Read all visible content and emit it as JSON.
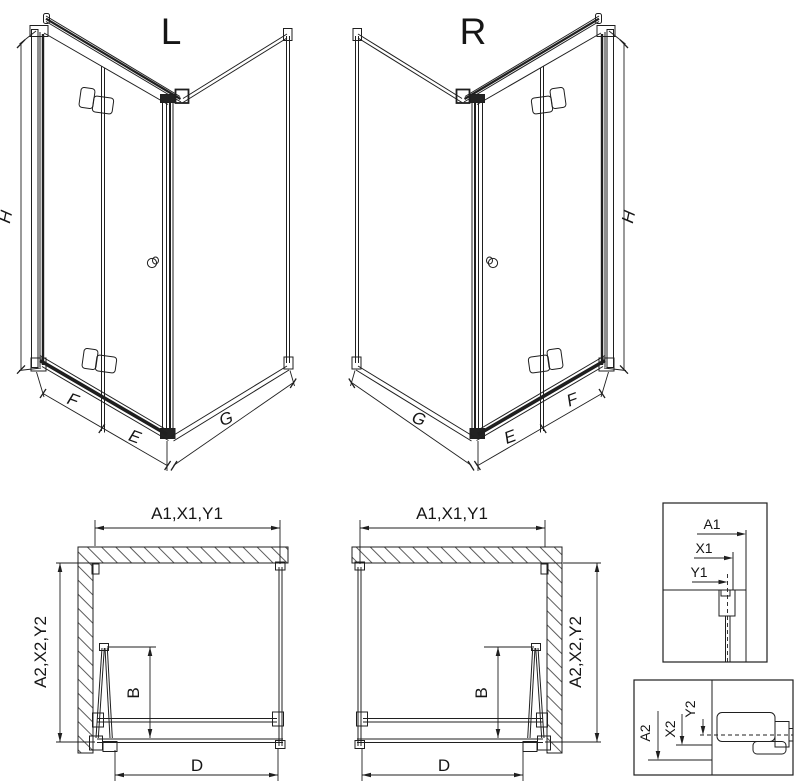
{
  "background": "#ffffff",
  "line_color": "#1f1f1f",
  "iso_left": {
    "title": "L",
    "dim_height": "H",
    "dim_f": "F",
    "dim_e": "E",
    "dim_g": "G"
  },
  "iso_right": {
    "title": "R",
    "dim_height": "H",
    "dim_f": "F",
    "dim_e": "E",
    "dim_g": "G"
  },
  "plan_left": {
    "dim_top": "A1,X1,Y1",
    "dim_side": "A2,X2,Y2",
    "dim_b": "B",
    "dim_d": "D"
  },
  "plan_right": {
    "dim_top": "A1,X1,Y1",
    "dim_side": "A2,X2,Y2",
    "dim_b": "B",
    "dim_d": "D"
  },
  "detail_top": {
    "dim_a1": "A1",
    "dim_x1": "X1",
    "dim_y1": "Y1"
  },
  "detail_bottom": {
    "dim_a2": "A2",
    "dim_x2": "X2",
    "dim_y2": "Y2"
  }
}
